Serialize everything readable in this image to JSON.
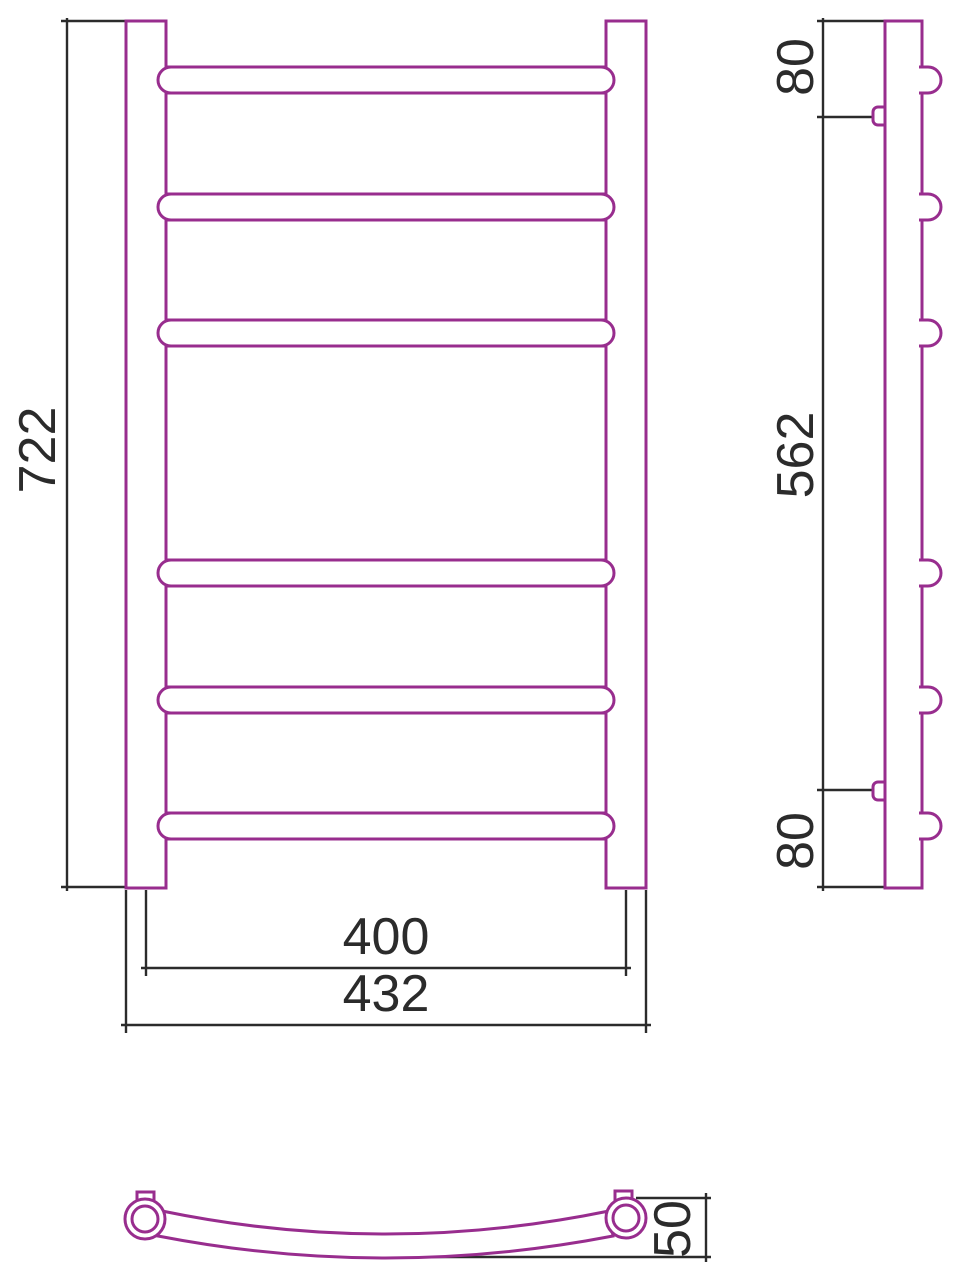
{
  "drawing": {
    "type": "technical-drawing",
    "subject": "ladder-towel-rail",
    "colors": {
      "outline": "#982d8e",
      "dimension": "#2b2b2b"
    },
    "front_view": {
      "rung_count": 6,
      "height_label": "722",
      "inner_width_label": "400",
      "outer_width_label": "432"
    },
    "side_view": {
      "top_offset_label": "80",
      "bracket_span_label": "562",
      "bottom_offset_label": "80"
    },
    "bottom_view": {
      "curve_depth_label": "50"
    }
  }
}
